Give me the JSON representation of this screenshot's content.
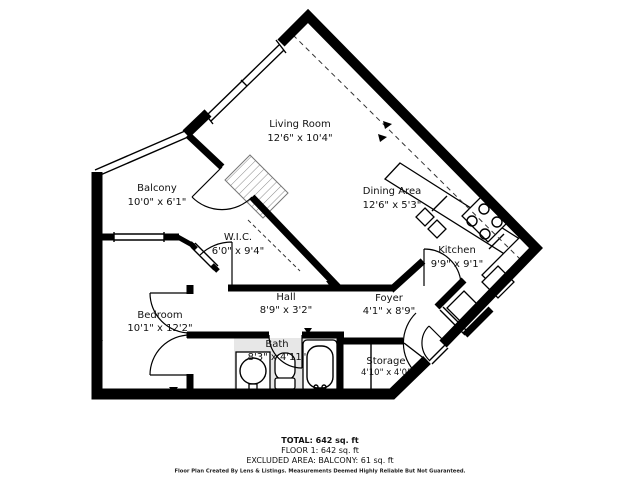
{
  "floorplan": {
    "rooms": [
      {
        "name": "Living Room",
        "dims": "12'6\" x 10'4\""
      },
      {
        "name": "Balcony",
        "dims": "10'0\" x 6'1\""
      },
      {
        "name": "Dining Area",
        "dims": "12'6\" x 5'3\""
      },
      {
        "name": "Kitchen",
        "dims": "9'9\" x 9'1\""
      },
      {
        "name": "W.I.C.",
        "dims": "6'0\" x 9'4\""
      },
      {
        "name": "Hall",
        "dims": "8'9\" x 3'2\""
      },
      {
        "name": "Bedroom",
        "dims": "10'1\" x 12'2\""
      },
      {
        "name": "Bath",
        "dims": "8'3\" x 4'11\""
      },
      {
        "name": "Foyer",
        "dims": "4'1\" x 8'9\""
      },
      {
        "name": "Storage",
        "dims": "4'10\" x 4'0\""
      }
    ],
    "icons": [
      "bathtub-icon",
      "toilet-icon",
      "bathroom-sink-icon",
      "kitchen-sink-icon",
      "stove-icon",
      "fridge-icon",
      "door-arc",
      "window",
      "hatch-area"
    ],
    "colors": {
      "wall": "#000000",
      "bath_fill": "#e7e7e7",
      "background": "#ffffff"
    }
  },
  "summary": {
    "total": "TOTAL: 642 sq. ft",
    "floor1": "FLOOR 1: 642 sq. ft",
    "excluded": "EXCLUDED AREA: BALCONY: 61 sq. ft",
    "disclaimer": "Floor Plan Created By Lens & Listings. Measurements Deemed Highly Reliable But Not Guaranteed."
  }
}
